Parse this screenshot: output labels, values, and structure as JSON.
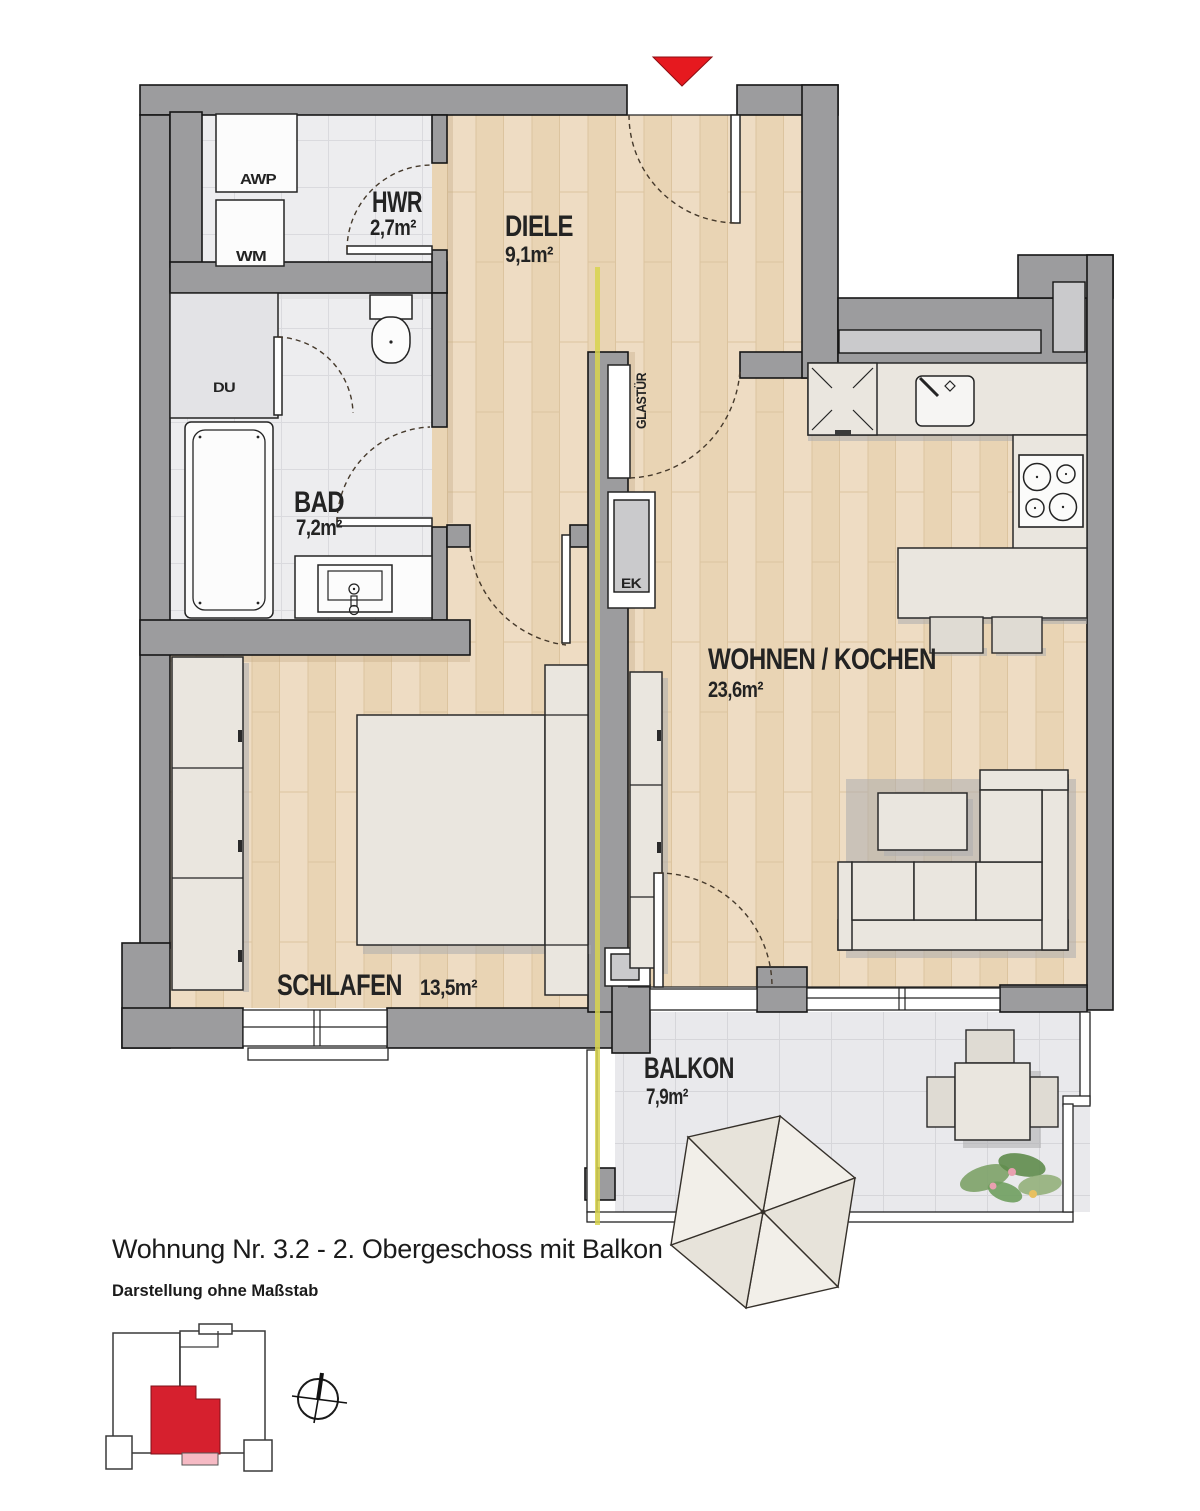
{
  "title_block": {
    "title": "Wohnung Nr. 3.2 - 2. Obergeschoss mit Balkon",
    "subtitle": "Darstellung ohne Maßstab"
  },
  "rooms": {
    "hwr": {
      "name": "HWR",
      "area": "2,7m²"
    },
    "diele": {
      "name": "DIELE",
      "area": "9,1m²"
    },
    "bad": {
      "name": "BAD",
      "area": "7,2m²"
    },
    "schlafen": {
      "name": "SCHLAFEN",
      "area": "13,5m²"
    },
    "wohnen": {
      "name": "WOHNEN / KOCHEN",
      "area": "23,6m²"
    },
    "balkon": {
      "name": "BALKON",
      "area": "7,9m²"
    }
  },
  "fixtures": {
    "awp": "AWP",
    "wm": "WM",
    "du": "DU",
    "ek": "EK",
    "glastuer": "GLASTÜR"
  },
  "colors": {
    "wall": "#9c9c9e",
    "wall_light": "#cacacc",
    "wood": "#eedcc3",
    "tile": "#ededef",
    "furniture": "#eae6df",
    "accent_red": "#e6191f",
    "unit_red": "#d6202e",
    "balcony_pink": "#f6bac4",
    "section_line": "#d8d44e"
  }
}
